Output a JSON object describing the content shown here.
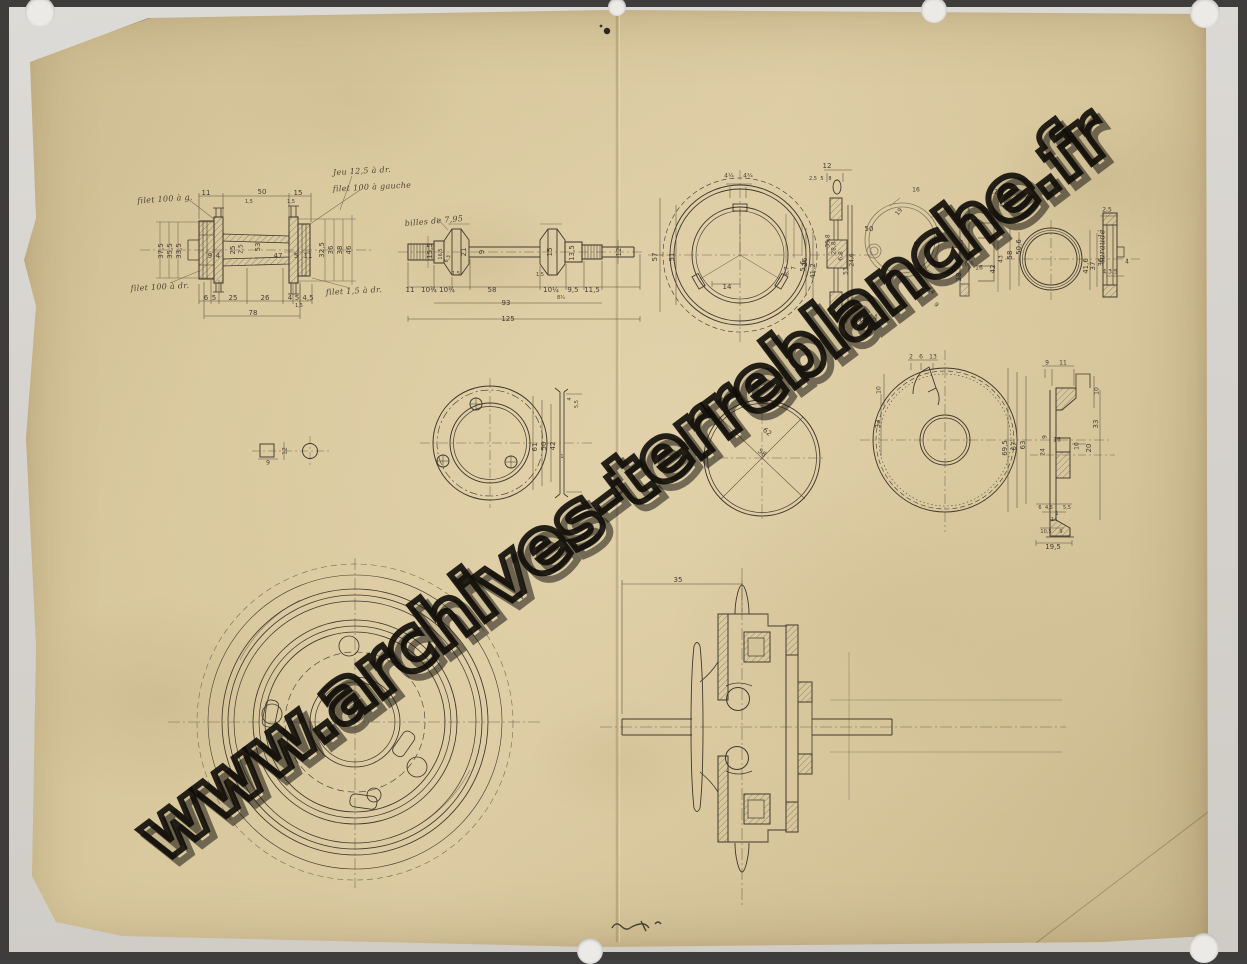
{
  "watermark": {
    "text": "www.archives-terreblanche.fr"
  },
  "notes": [
    {
      "t": "filet 100 à g.",
      "x": 165,
      "y": 199,
      "r": -4
    },
    {
      "t": "Jeu 12,5 à dr.",
      "x": 362,
      "y": 171,
      "r": -3
    },
    {
      "t": "filet 100 à gauche",
      "x": 372,
      "y": 187,
      "r": -3
    },
    {
      "t": "filet 100 à dr.",
      "x": 160,
      "y": 287,
      "r": -3
    },
    {
      "t": "filet 1,5 à dr.",
      "x": 354,
      "y": 291,
      "r": -3
    },
    {
      "t": "billes de 7,95",
      "x": 434,
      "y": 221,
      "r": -5
    },
    {
      "t": "Vis de 4",
      "x": 861,
      "y": 319,
      "r": -5
    },
    {
      "t": "taraudé",
      "x": 1102,
      "y": 246,
      "r": -90
    }
  ],
  "dim_labels": [
    {
      "t": "11",
      "x": 206,
      "y": 193
    },
    {
      "t": "50",
      "x": 262,
      "y": 192
    },
    {
      "t": "15",
      "x": 298,
      "y": 193
    },
    {
      "t": "1,5",
      "x": 249,
      "y": 202,
      "s": 5
    },
    {
      "t": "1,5",
      "x": 291,
      "y": 202,
      "s": 5
    },
    {
      "t": "37,5",
      "x": 161,
      "y": 251,
      "r": -90
    },
    {
      "t": "35,5",
      "x": 170,
      "y": 251,
      "r": -90
    },
    {
      "t": "33,5",
      "x": 179,
      "y": 251,
      "r": -90
    },
    {
      "t": "9",
      "x": 210,
      "y": 256
    },
    {
      "t": "4",
      "x": 218,
      "y": 256
    },
    {
      "t": "25",
      "x": 233,
      "y": 250,
      "r": -90
    },
    {
      "t": "2,5",
      "x": 241,
      "y": 249,
      "r": -90,
      "s": 6
    },
    {
      "t": "53",
      "x": 258,
      "y": 247,
      "r": -90
    },
    {
      "t": "47",
      "x": 278,
      "y": 256
    },
    {
      "t": "5",
      "x": 296,
      "y": 256
    },
    {
      "t": "11",
      "x": 308,
      "y": 256
    },
    {
      "t": "32,5",
      "x": 322,
      "y": 250,
      "r": -90
    },
    {
      "t": "36",
      "x": 331,
      "y": 250,
      "r": -90
    },
    {
      "t": "38",
      "x": 340,
      "y": 250,
      "r": -90
    },
    {
      "t": "46",
      "x": 349,
      "y": 250,
      "r": -90
    },
    {
      "t": "6",
      "x": 206,
      "y": 298
    },
    {
      "t": "5",
      "x": 214,
      "y": 298
    },
    {
      "t": "25",
      "x": 233,
      "y": 298
    },
    {
      "t": "26",
      "x": 265,
      "y": 298
    },
    {
      "t": "4",
      "x": 290,
      "y": 298
    },
    {
      "t": "5",
      "x": 297,
      "y": 298
    },
    {
      "t": "4,5",
      "x": 308,
      "y": 298
    },
    {
      "t": "1,5",
      "x": 299,
      "y": 306,
      "s": 5
    },
    {
      "t": "78",
      "x": 253,
      "y": 313
    },
    {
      "t": "15,5",
      "x": 430,
      "y": 251,
      "r": -90
    },
    {
      "t": "16,5",
      "x": 441,
      "y": 254,
      "r": -90,
      "s": 5
    },
    {
      "t": "6,5",
      "x": 448,
      "y": 259,
      "r": -60,
      "s": 5
    },
    {
      "t": "21",
      "x": 464,
      "y": 252,
      "r": -90
    },
    {
      "t": "9",
      "x": 482,
      "y": 252,
      "r": -90
    },
    {
      "t": "15",
      "x": 550,
      "y": 252,
      "r": -90
    },
    {
      "t": "13,5",
      "x": 572,
      "y": 253,
      "r": -90
    },
    {
      "t": "12",
      "x": 619,
      "y": 252,
      "r": -90
    },
    {
      "t": "1,5",
      "x": 456,
      "y": 274,
      "s": 5
    },
    {
      "t": "1,5",
      "x": 540,
      "y": 275,
      "s": 5
    },
    {
      "t": "11",
      "x": 410,
      "y": 290
    },
    {
      "t": "10¾",
      "x": 429,
      "y": 290
    },
    {
      "t": "10¾",
      "x": 447,
      "y": 290
    },
    {
      "t": "58",
      "x": 492,
      "y": 290
    },
    {
      "t": "10¼",
      "x": 551,
      "y": 290
    },
    {
      "t": "9,5",
      "x": 573,
      "y": 290
    },
    {
      "t": "11,5",
      "x": 592,
      "y": 290
    },
    {
      "t": "8¾",
      "x": 561,
      "y": 298,
      "s": 5
    },
    {
      "t": "93",
      "x": 506,
      "y": 303
    },
    {
      "t": "125",
      "x": 508,
      "y": 319
    },
    {
      "t": "4¼",
      "x": 729,
      "y": 176,
      "s": 6
    },
    {
      "t": "4¾",
      "x": 748,
      "y": 176,
      "s": 6
    },
    {
      "t": "57",
      "x": 655,
      "y": 257,
      "r": -90
    },
    {
      "t": "51",
      "x": 672,
      "y": 257,
      "r": -90
    },
    {
      "t": "14",
      "x": 727,
      "y": 287
    },
    {
      "t": "8,7",
      "x": 787,
      "y": 271,
      "r": -90,
      "s": 6
    },
    {
      "t": "7",
      "x": 794,
      "y": 268,
      "r": -90,
      "s": 6
    },
    {
      "t": "5,6",
      "x": 803,
      "y": 266,
      "r": -90
    },
    {
      "t": "12",
      "x": 827,
      "y": 166
    },
    {
      "t": "2,5",
      "x": 813,
      "y": 179,
      "s": 5
    },
    {
      "t": "5",
      "x": 822,
      "y": 179,
      "s": 5
    },
    {
      "t": "8",
      "x": 830,
      "y": 179,
      "s": 5
    },
    {
      "t": "26",
      "x": 805,
      "y": 262,
      "r": -90
    },
    {
      "t": "41,2",
      "x": 813,
      "y": 271,
      "r": -90
    },
    {
      "t": "35,8",
      "x": 828,
      "y": 241,
      "r": -90,
      "s": 6
    },
    {
      "t": "28,8",
      "x": 834,
      "y": 248,
      "r": -90,
      "s": 6
    },
    {
      "t": "6,8",
      "x": 841,
      "y": 256,
      "r": -90,
      "s": 6
    },
    {
      "t": "24,6",
      "x": 852,
      "y": 260,
      "r": -90,
      "s": 6
    },
    {
      "t": "53",
      "x": 846,
      "y": 271,
      "r": -90,
      "s": 6
    },
    {
      "t": "16",
      "x": 916,
      "y": 190,
      "s": 6
    },
    {
      "t": "50",
      "x": 869,
      "y": 229
    },
    {
      "t": "19",
      "x": 899,
      "y": 212,
      "r": -50,
      "s": 6
    },
    {
      "t": "9",
      "x": 917,
      "y": 243,
      "r": -90,
      "s": 6
    },
    {
      "t": "14",
      "x": 931,
      "y": 291,
      "r": 45,
      "s": 6
    },
    {
      "t": "9",
      "x": 936,
      "y": 305,
      "r": 45,
      "s": 6
    },
    {
      "t": "12,4",
      "x": 997,
      "y": 192,
      "s": 6
    },
    {
      "t": "4,3",
      "x": 1004,
      "y": 205,
      "s": 6
    },
    {
      "t": "1",
      "x": 962,
      "y": 243,
      "s": 6
    },
    {
      "t": "38",
      "x": 959,
      "y": 277,
      "r": -90
    },
    {
      "t": "6,6",
      "x": 969,
      "y": 264,
      "s": 6
    },
    {
      "t": "16",
      "x": 979,
      "y": 268,
      "s": 6
    },
    {
      "t": "42",
      "x": 993,
      "y": 269,
      "r": -90
    },
    {
      "t": "43",
      "x": 1001,
      "y": 259,
      "r": -90,
      "s": 6
    },
    {
      "t": "58",
      "x": 1010,
      "y": 255,
      "r": -90
    },
    {
      "t": "50,6",
      "x": 1019,
      "y": 247,
      "r": -90
    },
    {
      "t": "41,6",
      "x": 1086,
      "y": 266,
      "r": -90
    },
    {
      "t": "37",
      "x": 1093,
      "y": 266,
      "r": -90
    },
    {
      "t": "36",
      "x": 1101,
      "y": 262,
      "r": -90
    },
    {
      "t": "2,5",
      "x": 1107,
      "y": 210,
      "s": 6
    },
    {
      "t": "4",
      "x": 1127,
      "y": 262,
      "s": 6
    },
    {
      "t": "4,3,5",
      "x": 1110,
      "y": 272,
      "s": 6
    },
    {
      "t": "9",
      "x": 268,
      "y": 463,
      "s": 6
    },
    {
      "t": "12",
      "x": 285,
      "y": 451,
      "r": -90,
      "s": 6
    },
    {
      "t": "61",
      "x": 535,
      "y": 447,
      "r": -90
    },
    {
      "t": "50",
      "x": 544,
      "y": 446,
      "r": -90
    },
    {
      "t": "42",
      "x": 553,
      "y": 446,
      "r": -90
    },
    {
      "t": "4",
      "x": 570,
      "y": 399,
      "r": -90,
      "s": 5
    },
    {
      "t": "5,5",
      "x": 577,
      "y": 404,
      "r": -90,
      "s": 5
    },
    {
      "t": "1",
      "x": 562,
      "y": 457,
      "s": 5
    },
    {
      "t": "62",
      "x": 767,
      "y": 432,
      "r": 40
    },
    {
      "t": "58",
      "x": 762,
      "y": 453,
      "r": 40
    },
    {
      "t": "2",
      "x": 911,
      "y": 357,
      "s": 6
    },
    {
      "t": "6",
      "x": 921,
      "y": 357,
      "s": 6
    },
    {
      "t": "13",
      "x": 933,
      "y": 357,
      "s": 6
    },
    {
      "t": "10",
      "x": 879,
      "y": 390,
      "r": -90,
      "s": 6
    },
    {
      "t": "33",
      "x": 878,
      "y": 424,
      "r": -90
    },
    {
      "t": "69,5",
      "x": 1005,
      "y": 448,
      "r": -90
    },
    {
      "t": "67",
      "x": 1014,
      "y": 446,
      "r": -90
    },
    {
      "t": "63",
      "x": 1023,
      "y": 445,
      "r": -90
    },
    {
      "t": "9",
      "x": 1047,
      "y": 363,
      "s": 6
    },
    {
      "t": "11",
      "x": 1063,
      "y": 363,
      "s": 6
    },
    {
      "t": "10",
      "x": 1097,
      "y": 391,
      "r": -90,
      "s": 6
    },
    {
      "t": "33",
      "x": 1096,
      "y": 424,
      "r": -90
    },
    {
      "t": "9",
      "x": 1045,
      "y": 437,
      "r": -90,
      "s": 6
    },
    {
      "t": "16",
      "x": 1057,
      "y": 440,
      "s": 6
    },
    {
      "t": "24",
      "x": 1043,
      "y": 452,
      "r": -90,
      "s": 6
    },
    {
      "t": "10",
      "x": 1077,
      "y": 446,
      "r": -90,
      "s": 6
    },
    {
      "t": "20",
      "x": 1089,
      "y": 448,
      "r": -90
    },
    {
      "t": "6",
      "x": 1040,
      "y": 508,
      "s": 5
    },
    {
      "t": "4,5",
      "x": 1049,
      "y": 508,
      "s": 5
    },
    {
      "t": "1",
      "x": 1057,
      "y": 514,
      "s": 5
    },
    {
      "t": "5,5",
      "x": 1067,
      "y": 508,
      "s": 5
    },
    {
      "t": "14",
      "x": 1054,
      "y": 520,
      "s": 5
    },
    {
      "t": "10,5",
      "x": 1046,
      "y": 532,
      "s": 5
    },
    {
      "t": "9",
      "x": 1061,
      "y": 532,
      "s": 5
    },
    {
      "t": "19,5",
      "x": 1053,
      "y": 547
    },
    {
      "t": "35",
      "x": 678,
      "y": 580
    }
  ]
}
